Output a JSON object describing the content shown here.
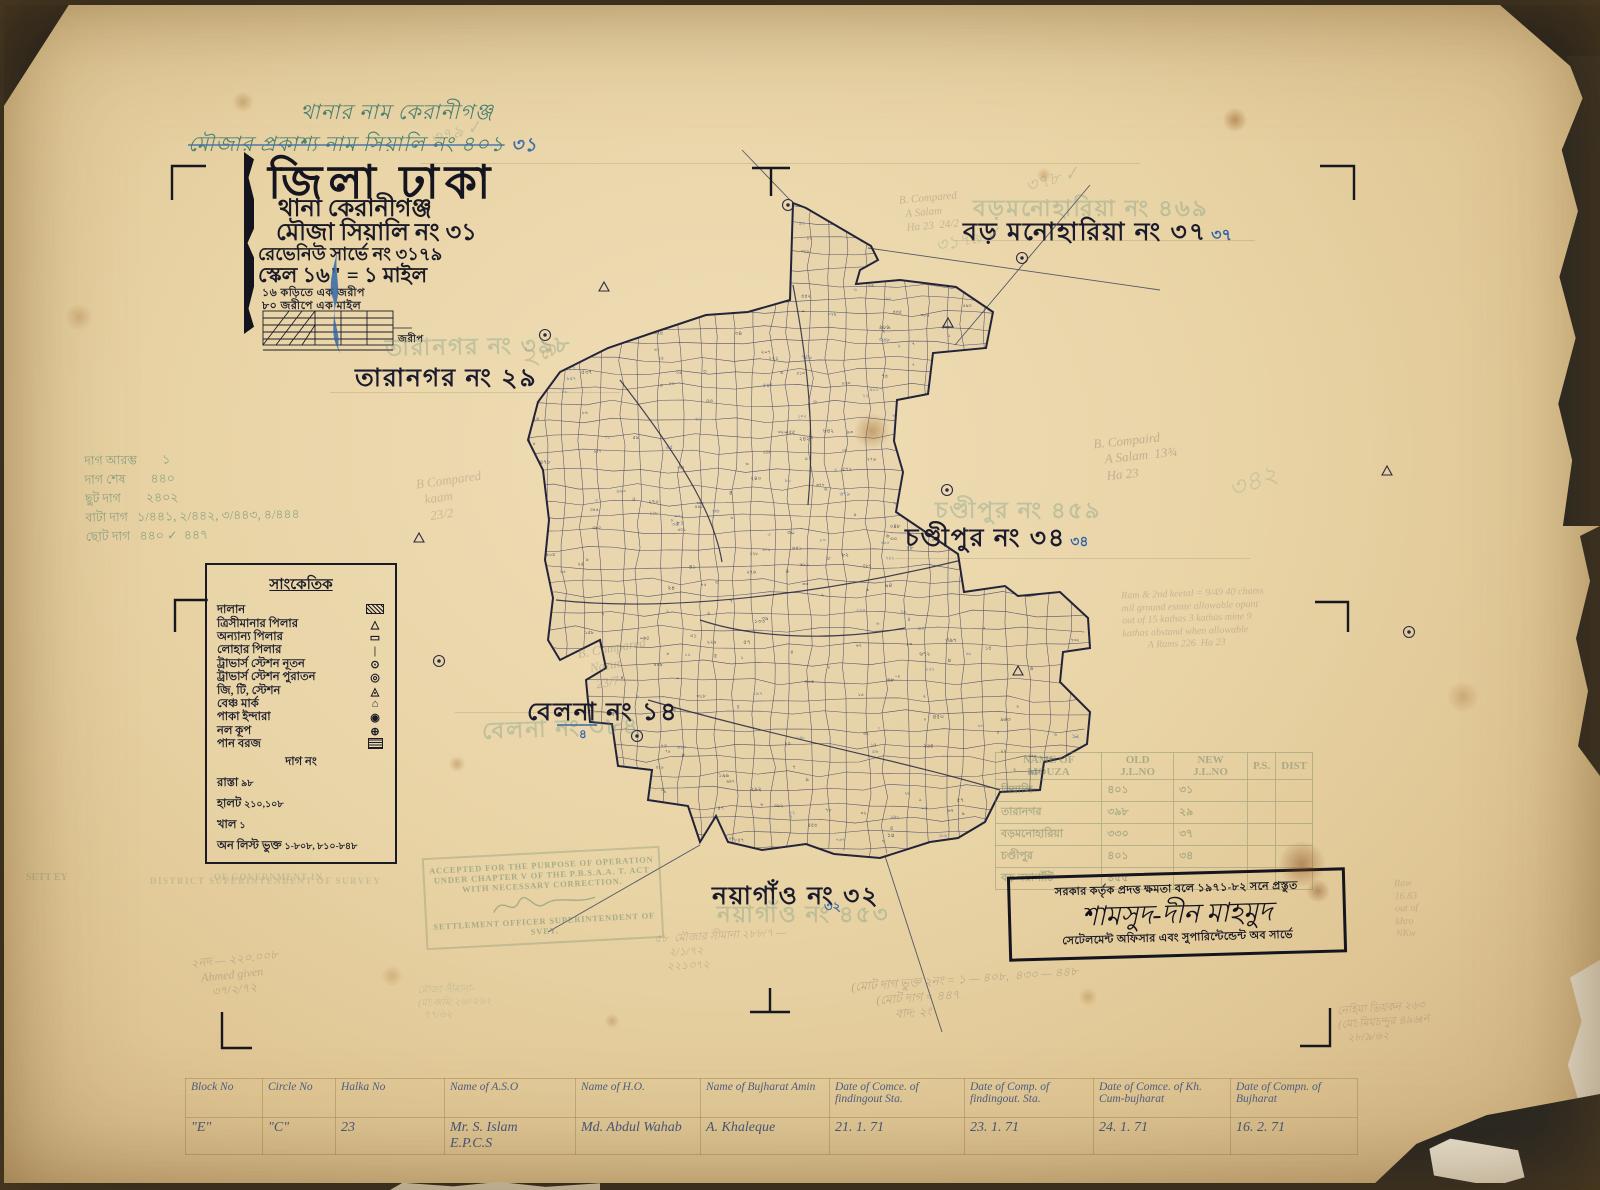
{
  "header_annotations": {
    "thana_line": "থানার নাম   কেরানীগঞ্জ",
    "mouza_line": "মৌজার প্রকাশ্য নাম   সিয়ালি নং ৪০১",
    "mouza_line_new": "৩১"
  },
  "title_block": {
    "district": "জিলা ঢাকা",
    "lines": [
      "থানা    কেরানীগঞ্জ",
      "মৌজা   সিয়ালি নং ৩১",
      "রেভেনিউ সার্ভে নং ৩১৭৯",
      "স্কেল ১৬\" = ১ মাইল"
    ],
    "small_lines": [
      "১৬ কড়িতে এক জরীপ",
      "৮০ জরীপে এক মাইল"
    ],
    "scale_bar_label": "জরীপ"
  },
  "map": {
    "neighbor_labels": [
      {
        "text": "তারানগর নং ২৯",
        "ghost": "তারানগর নং ৩৯৮",
        "blue": ""
      },
      {
        "text": "বড় মনোহারিয়া নং ৩৭",
        "ghost": "বড়মনোহারিয়া নং ৪৬৯",
        "blue": "৩৭"
      },
      {
        "text": "চণ্ডীপুর নং ৩৪",
        "ghost": "চণ্ডীপুর নং ৪৫৯",
        "blue": "৩৪"
      },
      {
        "text": "বেলনা নং ১৪",
        "ghost": "বেলনা নং ৩৮৪",
        "blue": "৪"
      },
      {
        "text": "নয়াগাঁও নং ৩২",
        "ghost": "নয়াগাঁও নং ৪৫৩",
        "blue": "৩২"
      }
    ]
  },
  "legend": {
    "title": "সাংকেতিক",
    "rows": [
      {
        "label": "দালান",
        "symbol": "hatch"
      },
      {
        "label": "ত্রিসীমানার পিলার",
        "symbol": "△"
      },
      {
        "label": "অন্যান্য পিলার",
        "symbol": "▭"
      },
      {
        "label": "লোহার পিলার",
        "symbol": "|"
      },
      {
        "label": "ট্রাভার্স স্টেশন নূতন",
        "symbol": "⊙"
      },
      {
        "label": "ট্রাভার্স স্টেশন পুরাতন",
        "symbol": "◎"
      },
      {
        "label": "জি, টি, স্টেশন",
        "symbol": "◬"
      },
      {
        "label": "বেঞ্চ মার্ক",
        "symbol": "⌂"
      },
      {
        "label": "পাকা ইন্দারা",
        "symbol": "◉"
      },
      {
        "label": "নল কূপ",
        "symbol": "⊕"
      },
      {
        "label": "পান বরজ",
        "symbol": "hatch2"
      }
    ],
    "extra": [
      {
        "label": "দাগ নং",
        "value": "",
        "center": true
      },
      {
        "label": "রাস্তা",
        "value": "৯৮"
      },
      {
        "label": "হালট",
        "value": "২১০,১০৮"
      },
      {
        "label": "খাল",
        "value": "১"
      },
      {
        "label": "অন লিস্ট ভুক্ত",
        "value": "১-৮০৮, ৮১০-৮৪৮"
      }
    ]
  },
  "green_notes": [
    "দাগ আরম্ভ        ১",
    "দাগ শেষ        ৪৪০",
    "ছুট দাগ        ২৪০২",
    "বাটা দাগ   ১/৪৪১, ২/৪৪২, ৩/৪৪৩, ৪/৪৪৪",
    "ছোট দাগ   ৪৪০ ✓  ৪৪৭"
  ],
  "stamps": {
    "accept": [
      "ACCEPTED FOR THE PURPOSE OF OPERATION",
      "UNDER CHAPTER V OF THE P.B.S.A.A. T. ACT",
      "WITH NECESSARY CORRECTION.",
      "SETTLEMENT OFFICER SUPERINTENDENT OF",
      "SVEY."
    ],
    "accept_side": "SETT EY",
    "govt_ghost": "OF GOVERNMENT IN",
    "district_ghost": "DISTRICT  SUPERINTENDENT OF SURVEY",
    "prep_line1": "সরকার কর্তৃক প্রদত্ত ক্ষমতা বলে ১৯৭১-৮২ সনে প্রস্তুত",
    "prep_signature": "শামসুদ-দীন মাহমুদ",
    "prep_line2": "সেটেলমেন্ট অফিসার এবং সুপারিন্টেন্ডেন্ট অব সার্ভে"
  },
  "mouza_table": {
    "headers": [
      "NAME OF MOUZA",
      "OLD J.L.NO",
      "NEW J.L.NO",
      "P.S.",
      "DIST"
    ],
    "rows": [
      [
        "সিয়ালি",
        "৪০১",
        "৩১",
        "",
        ""
      ],
      [
        "তারানগর",
        "৩৯৮",
        "২৯",
        "",
        ""
      ],
      [
        "বড়মনোহারিয়া",
        "৩৩০",
        "৩৭",
        "",
        ""
      ],
      [
        "চণ্ডীপুর",
        "৪০১",
        "৩৪",
        "",
        ""
      ],
      [
        "বড় নয়াগাঁটি",
        "৪৫৫",
        "",
        "",
        ""
      ]
    ]
  },
  "bottom_table": {
    "headers": [
      "Block No",
      "Circle No",
      "Halka No",
      "Name of A.S.O",
      "Name of H.O.",
      "Name of Bujharat Amin",
      "Date of Comce. of findingout Sta.",
      "Date of Comp. of findingout. Sta.",
      "Date of Comce. of Kh. Cum-bujharat",
      "Date of Compn. of Bujharat"
    ],
    "values": [
      "\"E\"",
      "\"C\"",
      "23",
      "Mr. S. Islam\nE.P.C.S",
      "Md. Abdul Wahab",
      "A. Khaleque",
      "21. 1. 71",
      "23. 1. 71",
      "24. 1. 71",
      "16. 2. 71"
    ]
  },
  "pencil_annotations": [
    {
      "text": "B Compared\n  kaam\n   23/2",
      "x": 418,
      "y": 472,
      "rot": -8,
      "size": 13,
      "color": "#b08878",
      "op": 0.45
    },
    {
      "text": "B. Compaird\n   A Salam  13¾\n   Ha 23",
      "x": 1095,
      "y": 432,
      "rot": -6,
      "size": 13,
      "color": "#8a8172",
      "op": 0.45
    },
    {
      "text": "B. Compared\n  A Salam\n  Ha 23  24/2",
      "x": 900,
      "y": 192,
      "rot": -5,
      "size": 11,
      "color": "#8a8172",
      "op": 0.4
    },
    {
      "text": "B. Compared\n   Nazur\n    23/7",
      "x": 580,
      "y": 640,
      "rot": -10,
      "size": 13,
      "color": "#8a8172",
      "op": 0.4
    },
    {
      "text": "Ram & 2nd keetal = 9/49 40 chams\nmil ground estate allowable opunt\nout of 15 kathas 3 kathas mine 9\nkathas abstand when allowable\n          A Rams 226  Ha 23",
      "x": 1122,
      "y": 588,
      "rot": -2,
      "size": 10,
      "color": "#8a8172",
      "op": 0.38
    },
    {
      "text": "(মোট দাগ ভুক্ত ২নং = ১ — ৪০৮,  ৪৩০ — ৪৪৮\n        (মোট দাগ = ৪৪৭\n              বাদ: ২ং",
      "x": 852,
      "y": 972,
      "rot": -4,
      "size": 12,
      "color": "#847c6c",
      "op": 0.45
    },
    {
      "text": "২নদ — ২২০.০০৮\n   Ahmed given\n      ৩৭/২/৭২",
      "x": 192,
      "y": 952,
      "rot": -6,
      "size": 12,
      "color": "#847c6c",
      "op": 0.4
    },
    {
      "text": "৫৮  মৌজার সীমানা ২৮৮/৭ —\n     ২/১/৭২\n    ২২১৩৭২",
      "x": 655,
      "y": 930,
      "rot": -3,
      "size": 11,
      "color": "#847c6c",
      "op": 0.38
    },
    {
      "text": "নেহিমা ভিয়কন ২৬৩\n(মো:মিয়চন্দুর ৪৯৬tন\n   ২৮/৯/৬২",
      "x": 1338,
      "y": 1002,
      "rot": -4,
      "size": 11,
      "color": "#847c6c",
      "op": 0.4
    },
    {
      "text": "৩৭৮ ✓",
      "x": 1025,
      "y": 168,
      "rot": -16,
      "size": 18,
      "color": "#8aa08a",
      "op": 0.4
    },
    {
      "text": "৩১৭৯ ✓",
      "x": 935,
      "y": 228,
      "rot": -12,
      "size": 18,
      "color": "#8aa08a",
      "op": 0.38
    },
    {
      "text": "৩৭৯ ✓",
      "x": 430,
      "y": 122,
      "rot": -15,
      "size": 17,
      "color": "#8aa08a",
      "op": 0.4
    },
    {
      "text": "২৯",
      "x": 518,
      "y": 334,
      "rot": -24,
      "size": 30,
      "color": "#8a8172",
      "op": 0.3
    },
    {
      "text": "৩৪২",
      "x": 1228,
      "y": 466,
      "rot": -20,
      "size": 26,
      "color": "#8aa08a",
      "op": 0.3
    },
    {
      "text": "Raw\n16.83\nout of\nkhro\nNKw",
      "x": 1395,
      "y": 878,
      "rot": -2,
      "size": 10,
      "color": "#8a8172",
      "op": 0.35
    },
    {
      "text": "মৌজা সীমানা-\n(মা:অমি:২৬//২৬২\n  ৭৭/৬২",
      "x": 418,
      "y": 984,
      "rot": -2,
      "size": 10,
      "color": "#8aa08a",
      "op": 0.35
    }
  ]
}
